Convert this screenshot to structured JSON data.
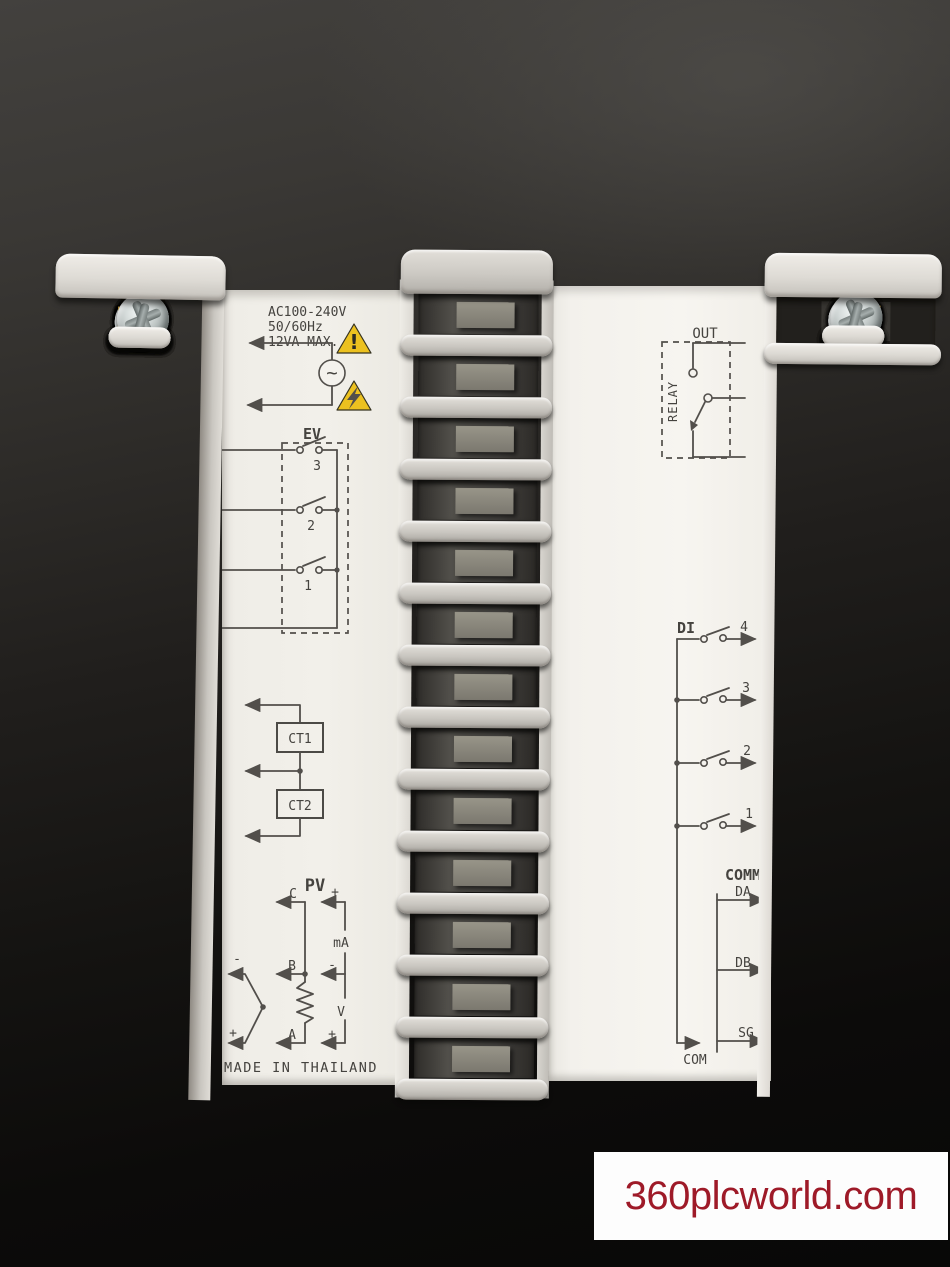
{
  "scene": {
    "watermark": "360plcworld.com"
  },
  "left_label": {
    "power": {
      "line1": "AC100-240V",
      "line2": "50/60Hz",
      "line3": "12VA MAX.",
      "ac_symbol": "~",
      "caution_mark": "!"
    },
    "ev": {
      "title": "EV",
      "contacts": [
        "3",
        "2",
        "1"
      ]
    },
    "ct": {
      "box1": "CT1",
      "box2": "CT2"
    },
    "pv": {
      "title": "PV",
      "c": "C",
      "b": "B",
      "a": "A",
      "ma": "mA",
      "v": "V",
      "c_plus": "+",
      "ma_minus": "-",
      "v_plus": "+",
      "tc_minus": "-",
      "tc_plus": "+"
    },
    "made_in": "MADE IN THAILAND"
  },
  "right_label": {
    "out": {
      "title": "OUT",
      "relay": "RELAY"
    },
    "di": {
      "title": "DI",
      "inputs": [
        "4",
        "3",
        "2",
        "1"
      ]
    },
    "comm": {
      "title": "COMM",
      "lines": [
        "DA",
        "DB",
        "SG"
      ],
      "com": "COM"
    }
  },
  "left_strip": {
    "terminals": [
      "screw",
      "screw",
      "screw",
      "screw",
      "screw",
      "screw",
      "screw",
      "screw",
      "screw",
      "screw",
      "screw",
      "screw"
    ]
  },
  "middle_strip": {
    "slots": [
      "empty",
      "empty",
      "empty",
      "empty",
      "empty",
      "empty",
      "empty",
      "empty",
      "empty",
      "empty",
      "empty",
      "empty",
      "empty"
    ]
  },
  "right_strip": {
    "terminals": [
      "screw",
      "screw",
      "screw",
      "dark",
      "screw",
      "screw",
      "screw",
      "screw",
      "screw",
      "screw",
      "screw",
      "screw"
    ]
  },
  "colors": {
    "background_dark": "#1c1a18",
    "plastic_light": "#dcd9d3",
    "brass": "#e2b95a",
    "screw_silver": "#c3cbca",
    "label_paper": "#f2f0ea",
    "label_ink": "#4f4d49",
    "warning_yellow": "#ecc11f",
    "watermark_red": "#9e1a28"
  }
}
